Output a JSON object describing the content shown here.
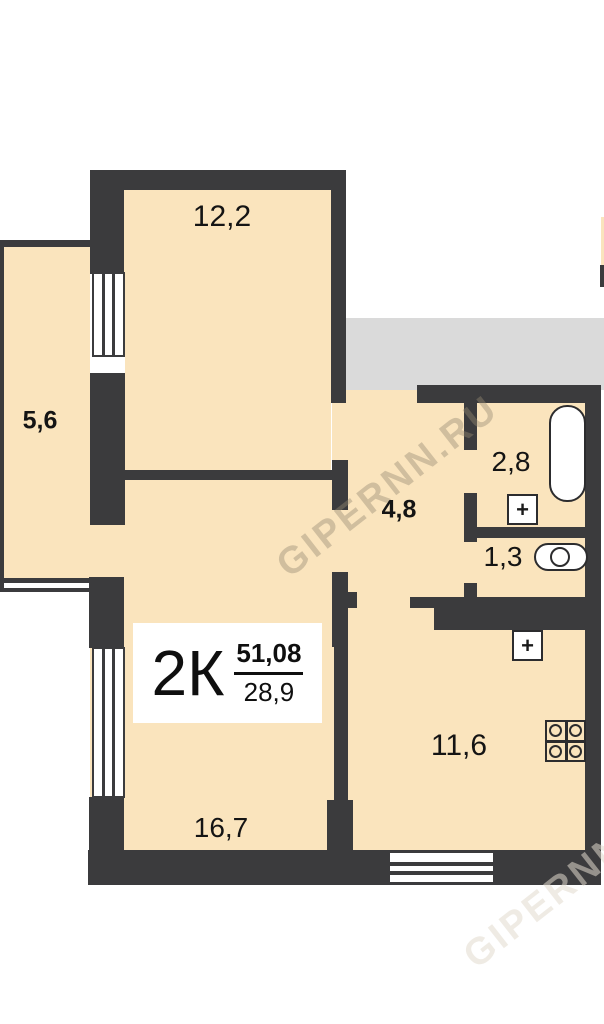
{
  "plan": {
    "watermark": "GIPERNN.RU",
    "apartment": {
      "type_label": "2К",
      "total_area": "51,08",
      "living_area": "28,9"
    },
    "rooms": [
      {
        "name": "bedroom",
        "label": "12,2"
      },
      {
        "name": "balcony",
        "label": "5,6"
      },
      {
        "name": "hallway",
        "label": "4,8"
      },
      {
        "name": "bathroom",
        "label": "2,8"
      },
      {
        "name": "wc",
        "label": "1,3"
      },
      {
        "name": "kitchen",
        "label": "11,6"
      },
      {
        "name": "living-room",
        "label": "16,7"
      }
    ],
    "fixtures": [
      {
        "name": "bathtub"
      },
      {
        "name": "washbasin",
        "symbol": "+"
      },
      {
        "name": "toilet"
      },
      {
        "name": "kitchen-sink",
        "symbol": "+"
      },
      {
        "name": "stove"
      }
    ],
    "colors": {
      "wall": "#3b3b3d",
      "floor": "#fae4bd",
      "common_area": "#dadada",
      "fixture_fill": "#ffffff"
    }
  }
}
